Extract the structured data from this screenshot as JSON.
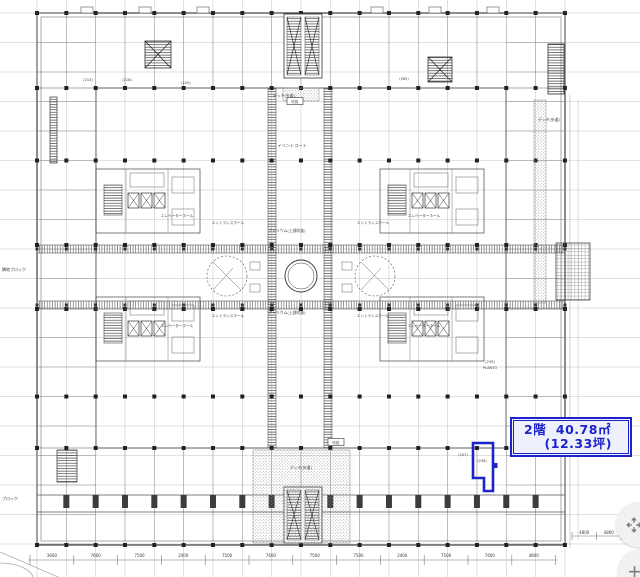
{
  "viewer": {
    "background": "#ffffff",
    "ink": "#3a3a3a",
    "grid_color": "#c3c3c3",
    "accent_blue": "#1c23c8"
  },
  "annotation": {
    "floor_area": "2階  40.78㎡",
    "tsubo": "(12.33坪)",
    "color": "#1c23c8"
  },
  "highlight": {
    "unit_number": "(238)",
    "color": "#1c23c8"
  },
  "controls": {
    "expand_icon": "expand-arrows-icon",
    "zoom_in_label": "+"
  },
  "plan": {
    "labels": [
      {
        "text": "エレベーターホール",
        "x": 177,
        "y": 217,
        "s": 3.6
      },
      {
        "text": "エレベーターホール",
        "x": 424,
        "y": 217,
        "s": 3.6
      },
      {
        "text": "エレベーターホール",
        "x": 177,
        "y": 327,
        "s": 3.6
      },
      {
        "text": "エレベーターホール",
        "x": 424,
        "y": 327,
        "s": 3.6
      },
      {
        "text": "エントランスホール",
        "x": 228,
        "y": 224,
        "s": 3.6
      },
      {
        "text": "エントランスホール",
        "x": 373,
        "y": 224,
        "s": 3.6
      },
      {
        "text": "エントランスホール",
        "x": 228,
        "y": 317,
        "s": 3.6
      },
      {
        "text": "エントランスホール",
        "x": 373,
        "y": 317,
        "s": 3.6
      },
      {
        "text": "アトリウム(上部吹抜)",
        "x": 287,
        "y": 232,
        "s": 3.8
      },
      {
        "text": "アトリウム(上部吹抜)",
        "x": 287,
        "y": 314,
        "s": 3.8
      },
      {
        "text": "イベントコート",
        "x": 292,
        "y": 147,
        "s": 4.2
      },
      {
        "text": "デッキ(歩道)",
        "x": 284,
        "y": 97,
        "s": 3.8
      },
      {
        "text": "デッキ(歩道)",
        "x": 549,
        "y": 121,
        "s": 3.8
      },
      {
        "text": "デッキ(歩道)",
        "x": 301,
        "y": 469,
        "s": 3.8
      },
      {
        "text": "隣地ブロック",
        "x": 14,
        "y": 271,
        "s": 4
      },
      {
        "text": "ブロック",
        "x": 10,
        "y": 500,
        "s": 4
      },
      {
        "text": "(213)",
        "x": 88,
        "y": 81,
        "s": 3.5
      },
      {
        "text": "(218)",
        "x": 127,
        "y": 81,
        "s": 3.5
      },
      {
        "text": "(220)",
        "x": 186,
        "y": 84,
        "s": 3.5
      },
      {
        "text": "(265)",
        "x": 404,
        "y": 80,
        "s": 3.5
      },
      {
        "text": "(239)",
        "x": 490,
        "y": 363,
        "s": 3.5
      },
      {
        "text": "PLANTO",
        "x": 490,
        "y": 369,
        "s": 3.5
      },
      {
        "text": "(237)",
        "x": 463,
        "y": 456,
        "s": 3.5
      },
      {
        "text": "(238)",
        "x": 482,
        "y": 462,
        "s": 3.5
      }
    ],
    "boxed_labels": [
      {
        "text": "吹抜",
        "x": 295,
        "y": 103
      },
      {
        "text": "吹抜",
        "x": 336,
        "y": 444
      }
    ],
    "dimensions_bottom": [
      "3600",
      "7600",
      "7500",
      "2400",
      "7500",
      "7600",
      "7500",
      "7500",
      "2400",
      "7500",
      "7600",
      "4800"
    ],
    "dimensions_right": [
      "4800",
      "4800"
    ]
  }
}
